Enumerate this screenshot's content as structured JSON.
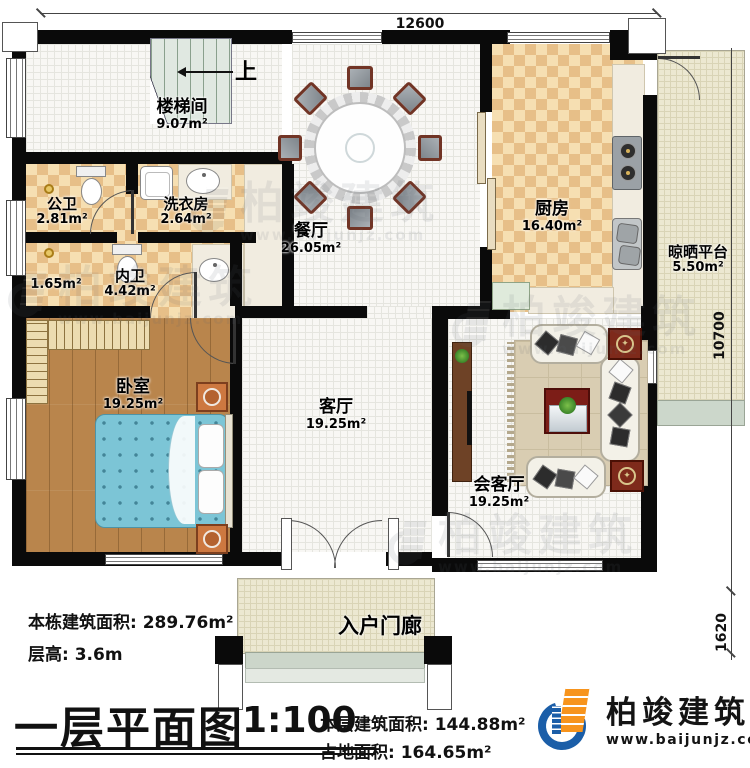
{
  "dimensions": {
    "top": "12600",
    "right": "10700",
    "right_lower": "1620"
  },
  "stairs": {
    "up_label": "上"
  },
  "rooms": {
    "stairwell": {
      "name": "楼梯间",
      "area": "9.07m²"
    },
    "public_bath": {
      "name": "公卫",
      "area": "2.81m²"
    },
    "laundry": {
      "name": "洗衣房",
      "area": "2.64m²"
    },
    "closet": {
      "area": "1.65m²"
    },
    "ensuite_bath": {
      "name": "内卫",
      "area": "4.42m²"
    },
    "bedroom": {
      "name": "卧室",
      "area": "19.25m²"
    },
    "dining": {
      "name": "餐厅",
      "area": "26.05m²"
    },
    "kitchen": {
      "name": "厨房",
      "area": "16.40m²"
    },
    "drying_platform": {
      "name": "晾晒平台",
      "area": "5.50m²"
    },
    "living": {
      "name": "客厅",
      "area": "19.25m²"
    },
    "reception": {
      "name": "会客厅",
      "area": "19.25m²"
    },
    "porch": {
      "name": "入户门廊"
    }
  },
  "info": {
    "building_total_area": "本栋建筑面积: 289.76m²",
    "floor_height": "层高: 3.6m",
    "title": "一层平面图",
    "scale": "1:100",
    "floor_area": "本层建筑面积: 144.88m²",
    "footprint_area": "占地面积: 164.65m²"
  },
  "logo": {
    "company": "柏竣建筑",
    "website": "www.baijunjz.com"
  },
  "watermark": {
    "company": "柏竣建筑",
    "website": "www.baijunjz.com"
  },
  "colors": {
    "wall": "#0a0a0a",
    "checker_tile": "#e7bf88",
    "wood_floor": "#b9854c",
    "bed": "#7cc5d6",
    "platform": "#ece8d1",
    "rug": "#d9cdb2",
    "logo_blue": "#1b5ea8",
    "logo_orange": "#f7941d"
  }
}
